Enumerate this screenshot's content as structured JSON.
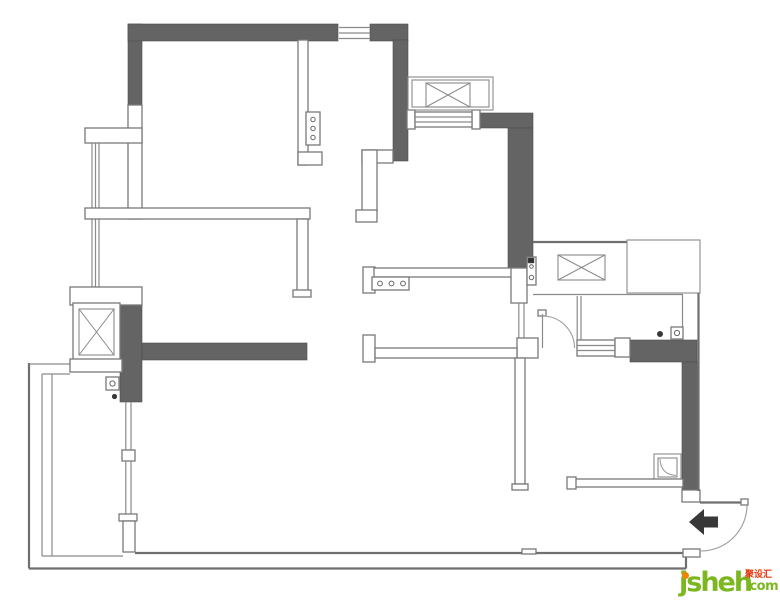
{
  "watermark": {
    "brand": "jsheh",
    "cjk_text": "聚设汇",
    "suffix": ".com"
  },
  "colors": {
    "background": "#ffffff",
    "wall-dark": "#646464",
    "wall-outline": "#787878",
    "line": "#8a8a8a",
    "line-strong": "#6f6f6f",
    "arrow": "#383838",
    "logo-green": "#7cb71f",
    "logo-orange": "#f08300",
    "logo-red": "#e8350c"
  },
  "plan": {
    "width": 780,
    "height": 602,
    "shapes": [
      {
        "t": "rect",
        "c": "wd",
        "n": "wall-north-west-pillar",
        "x": 128,
        "y": 24,
        "w": 14,
        "h": 81
      },
      {
        "t": "rect",
        "c": "wd",
        "n": "wall-north",
        "x": 128,
        "y": 24,
        "w": 210,
        "h": 17
      },
      {
        "t": "rect",
        "c": "wd",
        "n": "wall-north-right",
        "x": 370,
        "y": 24,
        "w": 38,
        "h": 17
      },
      {
        "t": "rect",
        "c": "wd",
        "n": "wall-kitchen-east",
        "x": 393,
        "y": 40,
        "w": 15,
        "h": 121
      },
      {
        "t": "rect",
        "c": "wd",
        "n": "wall-northeast",
        "x": 475,
        "y": 113,
        "w": 58,
        "h": 15
      },
      {
        "t": "rect",
        "c": "wd",
        "n": "wall-hall-east",
        "x": 508,
        "y": 128,
        "w": 25,
        "h": 140
      },
      {
        "t": "rect",
        "c": "wd",
        "n": "wall-southwest-pillar",
        "x": 120,
        "y": 305,
        "w": 22,
        "h": 97
      },
      {
        "t": "rect",
        "c": "wd",
        "n": "wall-living-south",
        "x": 142,
        "y": 343,
        "w": 165,
        "h": 17
      },
      {
        "t": "rect",
        "c": "wd",
        "n": "wall-bath-north",
        "x": 630,
        "y": 340,
        "w": 67,
        "h": 22
      },
      {
        "t": "rect",
        "c": "wd",
        "n": "wall-bath-east",
        "x": 682,
        "y": 362,
        "w": 16,
        "h": 128
      },
      {
        "t": "rect",
        "c": "ww",
        "n": "wall-west-upper",
        "x": 128,
        "y": 105,
        "w": 14,
        "h": 114
      },
      {
        "t": "rect",
        "c": "ww",
        "n": "bay-window-head",
        "x": 85,
        "y": 128,
        "w": 57,
        "h": 15
      },
      {
        "t": "line",
        "c": "ln",
        "n": "bay-window-line-1",
        "x1": 92,
        "y1": 143,
        "x2": 92,
        "y2": 287
      },
      {
        "t": "line",
        "c": "ln",
        "n": "bay-window-line-2",
        "x1": 95.5,
        "y1": 143,
        "x2": 95.5,
        "y2": 287
      },
      {
        "t": "line",
        "c": "ln",
        "n": "bay-window-line-3",
        "x1": 99,
        "y1": 143,
        "x2": 99,
        "y2": 287
      },
      {
        "t": "rect",
        "c": "ww",
        "n": "wall-bedroom1-south",
        "x": 85,
        "y": 208,
        "w": 225,
        "h": 11
      },
      {
        "t": "rect",
        "c": "ww",
        "n": "wall-bedroom1-east",
        "x": 297,
        "y": 219,
        "w": 11,
        "h": 73
      },
      {
        "t": "rect",
        "c": "ww",
        "n": "wall-bedroom1-east-cap",
        "x": 293,
        "y": 290,
        "w": 18,
        "h": 7
      },
      {
        "t": "rect",
        "c": "ww",
        "n": "wall-kitchen-west",
        "x": 298,
        "y": 40,
        "w": 10,
        "h": 125
      },
      {
        "t": "rect",
        "c": "ww",
        "n": "wall-kitchen-west-foot",
        "x": 298,
        "y": 152,
        "w": 24,
        "h": 13
      },
      {
        "t": "rect",
        "c": "ww",
        "n": "kitchen-panel-box",
        "x": 306,
        "y": 112,
        "w": 14,
        "h": 33
      },
      {
        "t": "circle",
        "c": "cir",
        "n": "kitchen-panel-knob-1",
        "cx": 313,
        "cy": 119.5,
        "r": 2.2
      },
      {
        "t": "circle",
        "c": "cir",
        "n": "kitchen-panel-knob-2",
        "cx": 313,
        "cy": 128.5,
        "r": 2.2
      },
      {
        "t": "circle",
        "c": "cir",
        "n": "kitchen-panel-knob-3",
        "cx": 313,
        "cy": 137.5,
        "r": 2.2
      },
      {
        "t": "rect",
        "c": "ww",
        "n": "wall-step-top",
        "x": 362,
        "y": 150,
        "w": 31,
        "h": 13
      },
      {
        "t": "rect",
        "c": "ww",
        "n": "wall-step-vertical",
        "x": 362,
        "y": 150,
        "w": 15,
        "h": 62
      },
      {
        "t": "rect",
        "c": "ww",
        "n": "wall-step-foot",
        "x": 356,
        "y": 210,
        "w": 21,
        "h": 12
      },
      {
        "t": "rect",
        "c": "ww",
        "n": "counter-end-cap",
        "x": 363,
        "y": 267,
        "w": 12,
        "h": 26
      },
      {
        "t": "rect",
        "c": "ww",
        "n": "counter-bar",
        "x": 374,
        "y": 268,
        "w": 139,
        "h": 9
      },
      {
        "t": "rect",
        "c": "ww",
        "n": "counter-hob-box",
        "x": 372,
        "y": 277,
        "w": 37,
        "h": 13
      },
      {
        "t": "circle",
        "c": "cir",
        "n": "counter-hob-knob-1",
        "cx": 380,
        "cy": 283.5,
        "r": 2.4
      },
      {
        "t": "circle",
        "c": "cir",
        "n": "counter-hob-knob-2",
        "cx": 391.5,
        "cy": 283.5,
        "r": 2.4
      },
      {
        "t": "circle",
        "c": "cir",
        "n": "counter-hob-knob-3",
        "cx": 403,
        "cy": 283.5,
        "r": 2.4
      },
      {
        "t": "rect",
        "c": "ww",
        "n": "hall-door-post",
        "x": 511,
        "y": 268,
        "w": 16,
        "h": 35
      },
      {
        "t": "rect",
        "c": "ww",
        "n": "hall-latch-box",
        "x": 527,
        "y": 257,
        "w": 9,
        "h": 28
      },
      {
        "t": "rect",
        "c": "dk",
        "n": "hall-latch-pin",
        "x": 528,
        "y": 258,
        "w": 6,
        "h": 5
      },
      {
        "t": "circle",
        "c": "cir",
        "n": "hall-latch-knob-1",
        "cx": 531.5,
        "cy": 266.5,
        "r": 1.8
      },
      {
        "t": "circle",
        "c": "cir",
        "n": "hall-latch-knob-2",
        "cx": 531.5,
        "cy": 277.5,
        "r": 2.2
      },
      {
        "t": "line",
        "c": "ln",
        "n": "hall-slider-line-1",
        "x1": 518.8,
        "y1": 303,
        "x2": 518.8,
        "y2": 340
      },
      {
        "t": "line",
        "c": "ln",
        "n": "hall-slider-line-2",
        "x1": 524,
        "y1": 303,
        "x2": 524,
        "y2": 340
      },
      {
        "t": "rect",
        "c": "ww",
        "n": "hall-junction-post",
        "x": 517,
        "y": 338,
        "w": 21,
        "h": 20
      },
      {
        "t": "rect",
        "c": "ww",
        "n": "wall-bedroom2-north-cap",
        "x": 363,
        "y": 335,
        "w": 12,
        "h": 27
      },
      {
        "t": "rect",
        "c": "ww",
        "n": "wall-bedroom2-north",
        "x": 375,
        "y": 348,
        "w": 142,
        "h": 10
      },
      {
        "t": "rect",
        "c": "ww",
        "n": "wall-bedroom2-east",
        "x": 515,
        "y": 358,
        "w": 10,
        "h": 126
      },
      {
        "t": "rect",
        "c": "ww",
        "n": "wall-bedroom2-east-cap",
        "x": 512,
        "y": 484,
        "w": 16,
        "h": 6
      },
      {
        "t": "rect",
        "c": "ww",
        "n": "bedroom2-door-leaf-tip",
        "x": 538,
        "y": 310,
        "w": 8,
        "h": 6
      },
      {
        "t": "line",
        "c": "ln",
        "n": "bedroom2-door-leaf",
        "x1": 542.5,
        "y1": 314,
        "x2": 542.5,
        "y2": 348
      },
      {
        "t": "path",
        "c": "arc",
        "n": "bedroom2-door-arc",
        "d": "M542.5,316 A32,32 0 0 1 574.5,348"
      },
      {
        "t": "line",
        "c": "ln",
        "n": "bath-west-line-1",
        "x1": 577.2,
        "y1": 296,
        "x2": 577.2,
        "y2": 340
      },
      {
        "t": "line",
        "c": "ln",
        "n": "bath-west-line-2",
        "x1": 581,
        "y1": 296,
        "x2": 581,
        "y2": 340
      },
      {
        "t": "rect",
        "c": "ww",
        "n": "bath-window",
        "x": 577,
        "y": 340,
        "w": 38,
        "h": 16
      },
      {
        "t": "line",
        "c": "ln",
        "n": "bath-window-line-1",
        "x1": 577,
        "y1": 345.5,
        "x2": 615,
        "y2": 345.5
      },
      {
        "t": "line",
        "c": "ln",
        "n": "bath-window-line-2",
        "x1": 577,
        "y1": 350.5,
        "x2": 615,
        "y2": 350.5
      },
      {
        "t": "rect",
        "c": "ww",
        "n": "bath-window-post",
        "x": 615,
        "y": 338,
        "w": 15,
        "h": 19
      },
      {
        "t": "rect",
        "c": "no",
        "n": "shower-tray-outer",
        "x": 654,
        "y": 454,
        "w": 27,
        "h": 27
      },
      {
        "t": "rect",
        "c": "no",
        "n": "shower-tray-inner",
        "x": 658,
        "y": 458,
        "w": 19,
        "h": 19
      },
      {
        "t": "path",
        "c": "arc",
        "n": "shower-tray-curve",
        "d": "M660,459 C660.5,469 665,474.5 676,475.5"
      },
      {
        "t": "rect",
        "c": "ww",
        "n": "wall-bath-south",
        "x": 568,
        "y": 479,
        "w": 115,
        "h": 8
      },
      {
        "t": "rect",
        "c": "ww",
        "n": "wall-bath-south-cap",
        "x": 567,
        "y": 477,
        "w": 9,
        "h": 12
      },
      {
        "t": "rect",
        "c": "ww",
        "n": "entry-wall-cap",
        "x": 682,
        "y": 490,
        "w": 18,
        "h": 12
      },
      {
        "t": "line",
        "c": "ln2",
        "n": "entry-door-leaf",
        "x1": 700,
        "y1": 502.5,
        "x2": 747,
        "y2": 502.5
      },
      {
        "t": "rect",
        "c": "ww",
        "n": "entry-door-leaf-tip",
        "x": 741,
        "y": 499,
        "w": 7,
        "h": 6
      },
      {
        "t": "path",
        "c": "arc",
        "n": "entry-door-arc",
        "d": "M747,505 A46,46 0 0 1 701,551"
      },
      {
        "t": "polygon",
        "c": "dot",
        "n": "entry-arrow",
        "p": "689,522 704,509 704,516.5 718,516.5 718,527.5 704,527.5 704,535"
      },
      {
        "t": "line",
        "c": "ln2",
        "n": "wall-south-inner",
        "x1": 135,
        "y1": 553,
        "x2": 686,
        "y2": 553
      },
      {
        "t": "line",
        "c": "ln2",
        "n": "wall-south-outer",
        "x1": 29,
        "y1": 568.5,
        "x2": 686,
        "y2": 568.5
      },
      {
        "t": "line",
        "c": "ln2",
        "n": "wall-south-end-connector",
        "x1": 686,
        "y1": 553,
        "x2": 686,
        "y2": 568.5
      },
      {
        "t": "rect",
        "c": "ww",
        "n": "entry-sill",
        "x": 683,
        "y": 549,
        "w": 17,
        "h": 8
      },
      {
        "t": "rect",
        "c": "ww",
        "n": "south-wall-tick",
        "x": 522,
        "y": 549,
        "w": 14,
        "h": 5
      },
      {
        "t": "line",
        "c": "ln2",
        "n": "balcony-west-outer",
        "x1": 29,
        "y1": 363,
        "x2": 29,
        "y2": 568.5
      },
      {
        "t": "line",
        "c": "ln",
        "n": "balcony-north-outer",
        "x1": 29,
        "y1": 364,
        "x2": 70,
        "y2": 364
      },
      {
        "t": "line",
        "c": "ln",
        "n": "balcony-west-inner",
        "x1": 42,
        "y1": 374,
        "x2": 42,
        "y2": 556
      },
      {
        "t": "line",
        "c": "ln",
        "n": "balcony-north-inner",
        "x1": 42,
        "y1": 374,
        "x2": 70,
        "y2": 374
      },
      {
        "t": "line",
        "c": "ln",
        "n": "balcony-west-inner-2",
        "x1": 52,
        "y1": 374,
        "x2": 52,
        "y2": 556
      },
      {
        "t": "line",
        "c": "ln",
        "n": "balcony-south-inner",
        "x1": 42,
        "y1": 556,
        "x2": 123,
        "y2": 556
      },
      {
        "t": "rect",
        "c": "ww",
        "n": "elevator-head",
        "x": 70,
        "y": 287,
        "w": 72,
        "h": 18
      },
      {
        "t": "rect",
        "c": "ww",
        "n": "elevator-box",
        "x": 73,
        "y": 303,
        "w": 47,
        "h": 58
      },
      {
        "t": "xbox",
        "c": "no",
        "n": "elevator-x-symbol",
        "x": 79,
        "y": 309,
        "w": 35,
        "h": 46
      },
      {
        "t": "rect",
        "c": "ww",
        "n": "elevator-foot",
        "x": 70,
        "y": 359,
        "w": 52,
        "h": 13
      },
      {
        "t": "rect",
        "c": "ww",
        "n": "balcony-latch-box",
        "x": 106,
        "y": 377,
        "w": 13,
        "h": 13
      },
      {
        "t": "circle",
        "c": "cir",
        "n": "balcony-latch-knob",
        "cx": 112.5,
        "cy": 383.5,
        "r": 2.6
      },
      {
        "t": "circle",
        "c": "dot",
        "n": "balcony-door-dot",
        "cx": 114.5,
        "cy": 396.5,
        "r": 2.6
      },
      {
        "t": "line",
        "c": "ln",
        "n": "balcony-slider-line-1",
        "x1": 125.8,
        "y1": 402,
        "x2": 125.8,
        "y2": 451
      },
      {
        "t": "line",
        "c": "ln",
        "n": "balcony-slider-line-2",
        "x1": 131,
        "y1": 402,
        "x2": 131,
        "y2": 451
      },
      {
        "t": "rect",
        "c": "ww",
        "n": "balcony-slider-mid",
        "x": 122,
        "y": 450,
        "w": 13,
        "h": 11
      },
      {
        "t": "line",
        "c": "ln",
        "n": "balcony-slider-line-3",
        "x1": 125.8,
        "y1": 461,
        "x2": 125.8,
        "y2": 514
      },
      {
        "t": "line",
        "c": "ln",
        "n": "balcony-slider-line-4",
        "x1": 131,
        "y1": 461,
        "x2": 131,
        "y2": 514
      },
      {
        "t": "rect",
        "c": "ww",
        "n": "balcony-slider-end",
        "x": 119,
        "y": 514,
        "w": 18,
        "h": 7
      },
      {
        "t": "rect",
        "c": "ww",
        "n": "wall-balcony-post",
        "x": 123,
        "y": 521,
        "w": 12,
        "h": 31
      },
      {
        "t": "line",
        "c": "ln",
        "n": "north-window-line-1",
        "x1": 339,
        "y1": 27.5,
        "x2": 370,
        "y2": 27.5
      },
      {
        "t": "line",
        "c": "ln",
        "n": "north-window-line-2",
        "x1": 339,
        "y1": 33,
        "x2": 370,
        "y2": 33
      },
      {
        "t": "line",
        "c": "ln",
        "n": "north-window-line-3",
        "x1": 339,
        "y1": 38.5,
        "x2": 370,
        "y2": 38.5
      },
      {
        "t": "rect",
        "c": "ww",
        "n": "ne-window-post-west",
        "x": 407,
        "y": 110,
        "w": 8,
        "h": 19
      },
      {
        "t": "rect",
        "c": "ww",
        "n": "ne-window-post-east",
        "x": 472,
        "y": 110,
        "w": 8,
        "h": 19
      },
      {
        "t": "rect",
        "c": "ww",
        "n": "ne-window",
        "x": 415,
        "y": 112,
        "w": 57,
        "h": 15
      },
      {
        "t": "line",
        "c": "ln",
        "n": "ne-window-line-1",
        "x1": 415,
        "y1": 117,
        "x2": 472,
        "y2": 117
      },
      {
        "t": "line",
        "c": "ln",
        "n": "ne-window-line-2",
        "x1": 415,
        "y1": 122,
        "x2": 472,
        "y2": 122
      },
      {
        "t": "rect",
        "c": "no",
        "n": "ne-shaft-outer",
        "x": 408,
        "y": 77,
        "w": 85,
        "h": 33
      },
      {
        "t": "rect",
        "c": "no",
        "n": "ne-shaft-inner",
        "x": 412,
        "y": 80,
        "w": 77,
        "h": 27
      },
      {
        "t": "xbox",
        "c": "no",
        "n": "ne-shaft-x-symbol",
        "x": 426,
        "y": 83,
        "w": 44,
        "h": 24
      },
      {
        "t": "line",
        "c": "ln2",
        "n": "closet-north-line",
        "x1": 533,
        "y1": 242,
        "x2": 627,
        "y2": 242
      },
      {
        "t": "rect",
        "c": "no",
        "n": "utility-box",
        "x": 627,
        "y": 240,
        "w": 73,
        "h": 53
      },
      {
        "t": "line",
        "c": "ln",
        "n": "closet-south-line",
        "x1": 533,
        "y1": 294.5,
        "x2": 683,
        "y2": 294.5
      },
      {
        "t": "xbox",
        "c": "no",
        "n": "closet-x-symbol",
        "x": 558,
        "y": 255,
        "w": 47,
        "h": 25
      },
      {
        "t": "line",
        "c": "ln",
        "n": "bath-niche-line",
        "x1": 682.5,
        "y1": 294.5,
        "x2": 682.5,
        "y2": 340
      },
      {
        "t": "line",
        "c": "ln2",
        "n": "wall-east-outer",
        "x1": 698.5,
        "y1": 293,
        "x2": 698.5,
        "y2": 491
      },
      {
        "t": "circle",
        "c": "dot",
        "n": "bath-door-dot",
        "cx": 660,
        "cy": 334,
        "r": 3
      },
      {
        "t": "rect",
        "c": "ww",
        "n": "bath-door-box",
        "x": 671,
        "y": 327,
        "w": 12,
        "h": 12
      },
      {
        "t": "circle",
        "c": "cir",
        "n": "bath-door-knob",
        "cx": 677,
        "cy": 333,
        "r": 2.6
      }
    ]
  }
}
